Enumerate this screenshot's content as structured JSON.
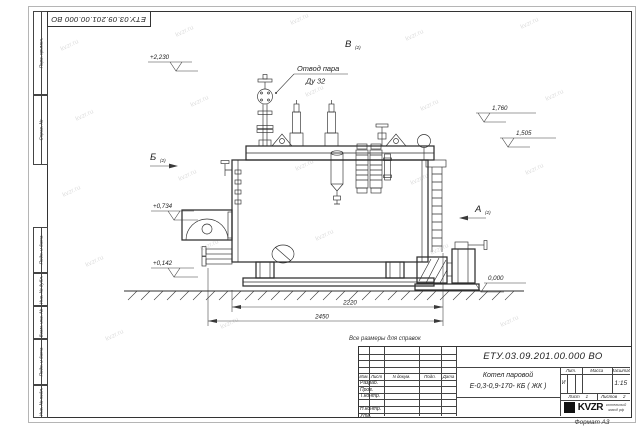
{
  "page": {
    "watermark": "kvzr.ru",
    "note": "Все размеры для справок",
    "format_label": "Формат А3"
  },
  "frame": {
    "corner_doc_number": "ЕТУ.03.09.201.00.000  ВО",
    "margin_labels": {
      "perv_primen": "Перв. примен.",
      "sprav_no": "Справ. №",
      "podp_data_1": "Подп. и дата",
      "inv_dubl": "Инв. № дубл.",
      "vzam_inv": "Взам. инв. №",
      "podp_data_2": "Подп. и дата",
      "inv_podl": "Инв. № подл."
    }
  },
  "drawing": {
    "callout": {
      "line1": "Отвод пара",
      "line2": "Ду 32"
    },
    "elevations": {
      "top": "+2,230",
      "e1760": "1,760",
      "e1505": "1,505",
      "e0734": "+0,734",
      "e0142": "+0,142",
      "zero": "0,000"
    },
    "views": {
      "b": "Б",
      "b_sub": "(2)",
      "v": "В",
      "v_sub": "(2)",
      "a": "А",
      "a_sub": "(2)"
    },
    "dimensions": {
      "body_length": "2220",
      "overall_length": "2450"
    }
  },
  "title_block": {
    "doc_number": "ЕТУ.03.09.201.00.000  ВО",
    "name_line1": "Котел паровой",
    "name_line2": "Е-0,3-0,9-170- КБ ( ЖК )",
    "header_cols": {
      "izm": "Изм.",
      "list": "Лист",
      "doc": "N докум.",
      "podp": "Подп.",
      "data": "Дата"
    },
    "rows": {
      "razrab": "Разраб.",
      "prov": "Пров.",
      "tkontr": "Т.контр.",
      "nkontr": "Н.контр.",
      "utv": "Утв."
    },
    "lit_header": "Лит.",
    "mass_header": "Масса",
    "scale_header": "Масштаб",
    "lit_value": "И",
    "scale_value": "1:15",
    "sheet_label": "Лист",
    "sheet_value": "1",
    "sheets_label": "Листов",
    "sheets_value": "2",
    "company": {
      "logo": "KVZR",
      "line1": "котельный",
      "line2": "завод рф"
    }
  }
}
